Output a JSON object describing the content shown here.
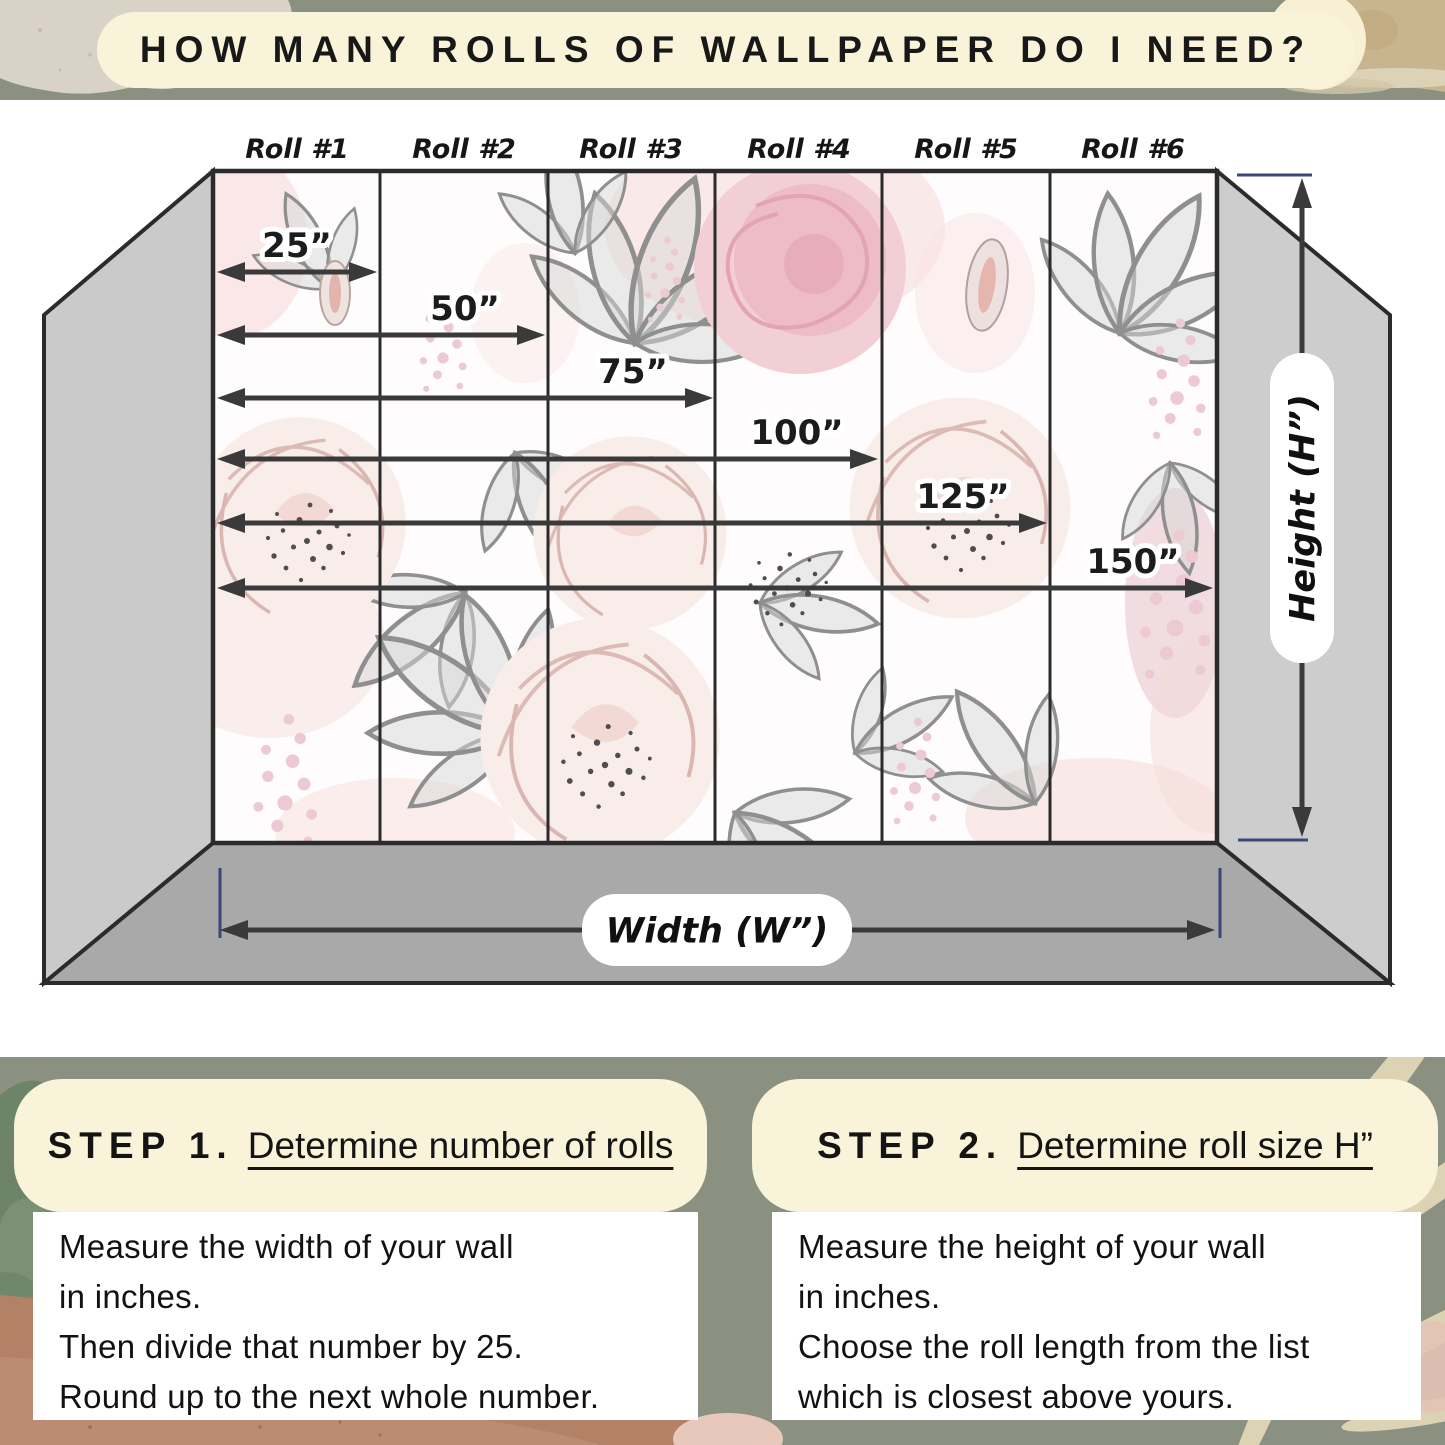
{
  "title": "HOW MANY ROLLS OF WALLPAPER DO I NEED?",
  "room": {
    "roll_labels": [
      "Roll #1",
      "Roll #2",
      "Roll #3",
      "Roll #4",
      "Roll #5",
      "Roll #6"
    ],
    "measurements": [
      "25”",
      "50”",
      "75”",
      "100”",
      "125”",
      "150”"
    ],
    "height_label": "Height (H”)",
    "width_label": "Width (W”)"
  },
  "steps": [
    {
      "name": "STEP 1.",
      "heading": "Determine number of rolls",
      "lines": [
        "Measure the width of your wall",
        "in inches.",
        "Then divide that number by 25.",
        "Round up to the next whole number."
      ]
    },
    {
      "name": "STEP 2.",
      "heading": "Determine roll size H”",
      "lines": [
        "Measure the height of your wall",
        "in inches.",
        "Choose the roll length from the list",
        "which is closest above yours."
      ]
    }
  ],
  "colors": {
    "sage_background": "#8A9181",
    "cream_panel": "#F8F3D9",
    "side_wall_gray": "#CACACA",
    "floor_gray": "#A9A9A9",
    "outline_dark": "#2B2B2B",
    "arrow_dark": "#3A3A3A",
    "tick_navy": "#3A4877",
    "wallpaper_rose_pink": "#F2CFD5",
    "wallpaper_leaf_gray": "#8F8F8F",
    "texture_beige": "#D9D3C7",
    "texture_tan": "#C8B48E",
    "texture_copper": "#B28166"
  }
}
